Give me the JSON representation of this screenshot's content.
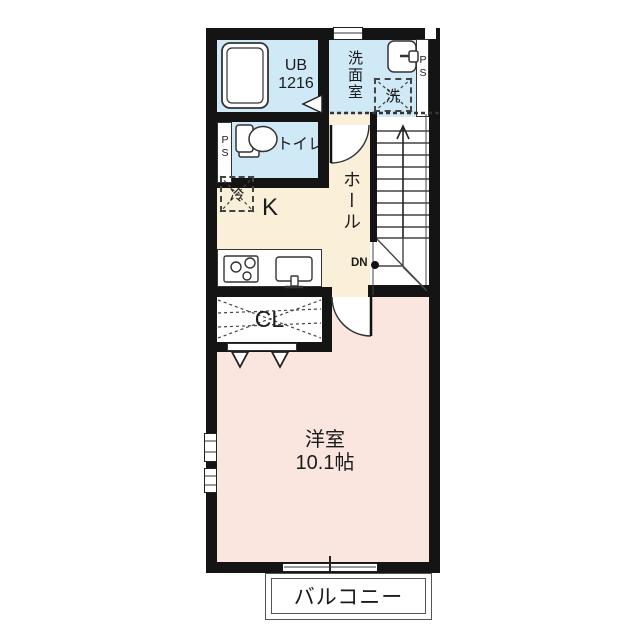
{
  "fp": {
    "unit_bath": {
      "name": "UB",
      "size": "1216"
    },
    "washroom": "洗面室",
    "washer": "洗",
    "toilet": "トイレ",
    "fridge": "冷",
    "kitchen": "K",
    "hall": "ホール",
    "closet": "CL",
    "western_room": {
      "name": "洋室",
      "size": "10.1帖"
    },
    "balcony": "バルコニー",
    "stairs": {
      "down": "DN"
    },
    "pipe_space_left": "PS",
    "pipe_space_right": "PS",
    "colors": {
      "wet_area_floor": "#cfe9f6",
      "kitchen_hall_floor": "#faf0d9",
      "room_floor": "#fbe5df",
      "wall": "#141414",
      "line": "#333333"
    },
    "icons": {
      "bathtub": "bathtub-icon",
      "washbasin": "washbasin-icon",
      "washer_space": "washer-space-box",
      "toilet": "toilet-icon",
      "fridge_space": "fridge-space-box",
      "stove": "stove-icon",
      "kitchen_sink": "kitchen-sink-icon",
      "stairs_arrow": "stairs-up-arrow-icon",
      "door_swing": "door-swing-arc"
    }
  }
}
